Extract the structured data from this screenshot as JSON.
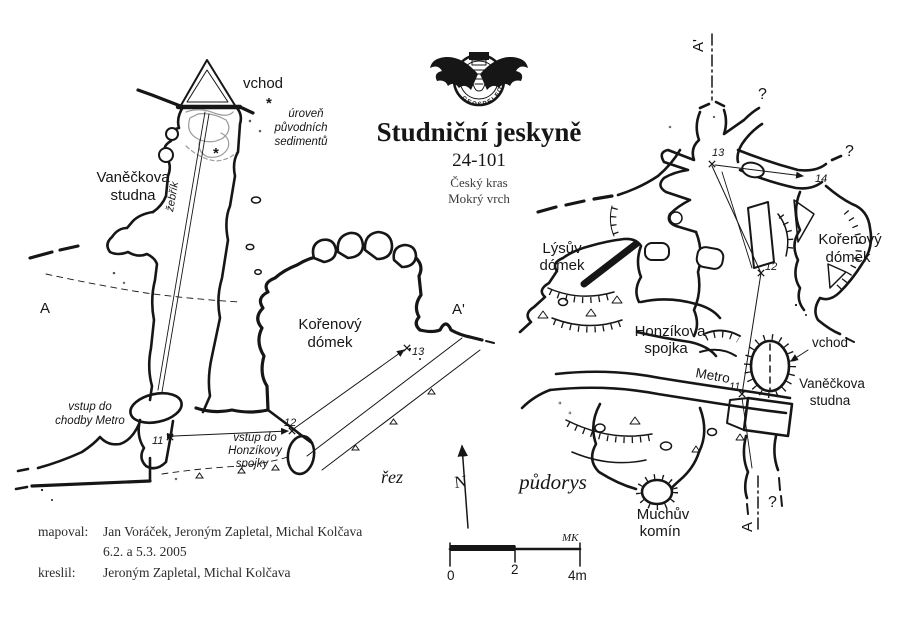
{
  "header": {
    "logo_text": "GEOSPELEOS",
    "title": "Studniční jeskyně",
    "cave_number": "24-101",
    "region": "Český kras",
    "locality": "Mokrý vrch"
  },
  "section": {
    "view_label": "řez",
    "entrance_label": "vchod",
    "well_label_1": "Vaněčkova",
    "well_label_2": "studna",
    "ladder_label": "žebřík",
    "star": "*",
    "note_1": "úroveň",
    "note_2": "původních",
    "note_3": "sedimentů",
    "dome_label_1": "Kořenový",
    "dome_label_2": "dómek",
    "metro_entry_1": "vstup do",
    "metro_entry_2": "chodby Metro",
    "spojka_entry_1": "vstup do",
    "spojka_entry_2": "Honzíkovy",
    "spojka_entry_3": "spojky",
    "point_a": "A",
    "point_a_prime": "A'",
    "st11": "11",
    "st12": "12",
    "st13": "13"
  },
  "plan": {
    "view_label": "půdorys",
    "lysuv_1": "Lýsův",
    "lysuv_2": "dómek",
    "korenovy_1": "Kořenový",
    "korenovy_2": "dómek",
    "spojka_1": "Honzíkova",
    "spojka_2": "spojka",
    "metro_label": "Metro",
    "entrance_label": "vchod",
    "well_1": "Vaněčkova",
    "well_2": "studna",
    "chimney_1": "Muchův",
    "chimney_2": "komín",
    "point_a": "A",
    "point_a_prime": "A'",
    "q_top": "?",
    "q_right": "?",
    "q_bottom": "?",
    "st11": "11",
    "st12": "12",
    "st13": "13",
    "st14": "14"
  },
  "compass": {
    "north_label": "N"
  },
  "scale_bar": {
    "tick0": "0",
    "tick2": "2",
    "tick4": "4m",
    "initials": "MK"
  },
  "credits": {
    "mapped_label": "mapoval:",
    "mapped_names": "Jan Voráček, Jeroným Zapletal, Michal Kolčava",
    "mapped_date": "6.2. a 5.3. 2005",
    "drawn_label": "kreslil:",
    "drawn_names": "Jeroným Zapletal, Michal Kolčava"
  },
  "colors": {
    "ink": "#161616",
    "sketch": "#9b9b9b",
    "paper": "#ffffff"
  }
}
